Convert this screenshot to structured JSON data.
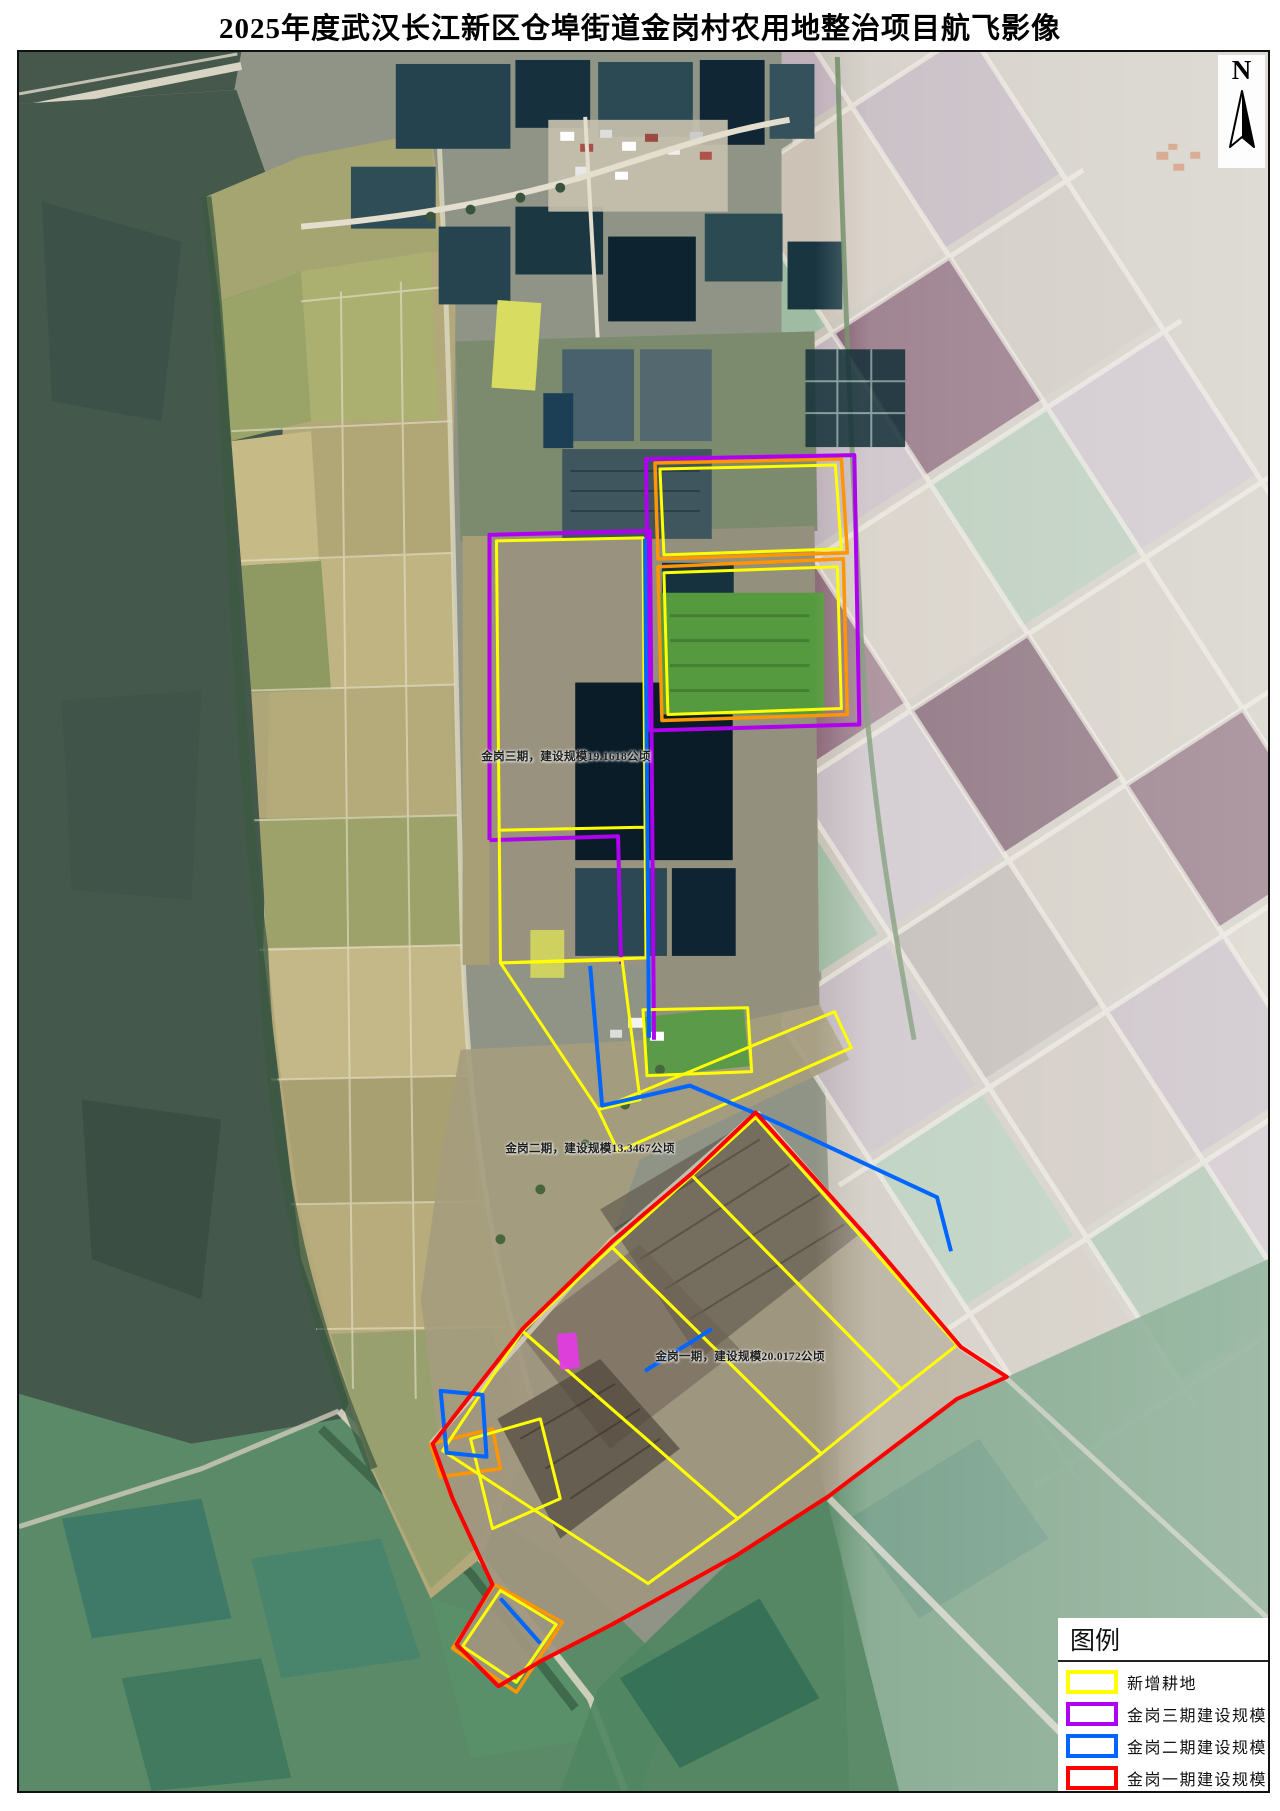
{
  "title": "2025年度武汉长江新区仓埠街道金岗村农用地整治项目航飞影像",
  "north": {
    "label": "N"
  },
  "map_labels": [
    {
      "id": "phase3",
      "text": "金岗三期，建设规模19.1618公顷"
    },
    {
      "id": "phase2",
      "text": "金岗二期，建设规模13.3467公顷"
    },
    {
      "id": "phase1",
      "text": "金岗一期，建设规模20.0172公顷"
    }
  ],
  "legend": {
    "title": "图例",
    "items": [
      {
        "label": "新增耕地",
        "color": "#ffff00"
      },
      {
        "label": "金岗三期建设规模",
        "color": "#b000f0"
      },
      {
        "label": "金岗二期建设规模",
        "color": "#0066ff"
      },
      {
        "label": "金岗一期建设规模",
        "color": "#ff0000"
      }
    ]
  }
}
